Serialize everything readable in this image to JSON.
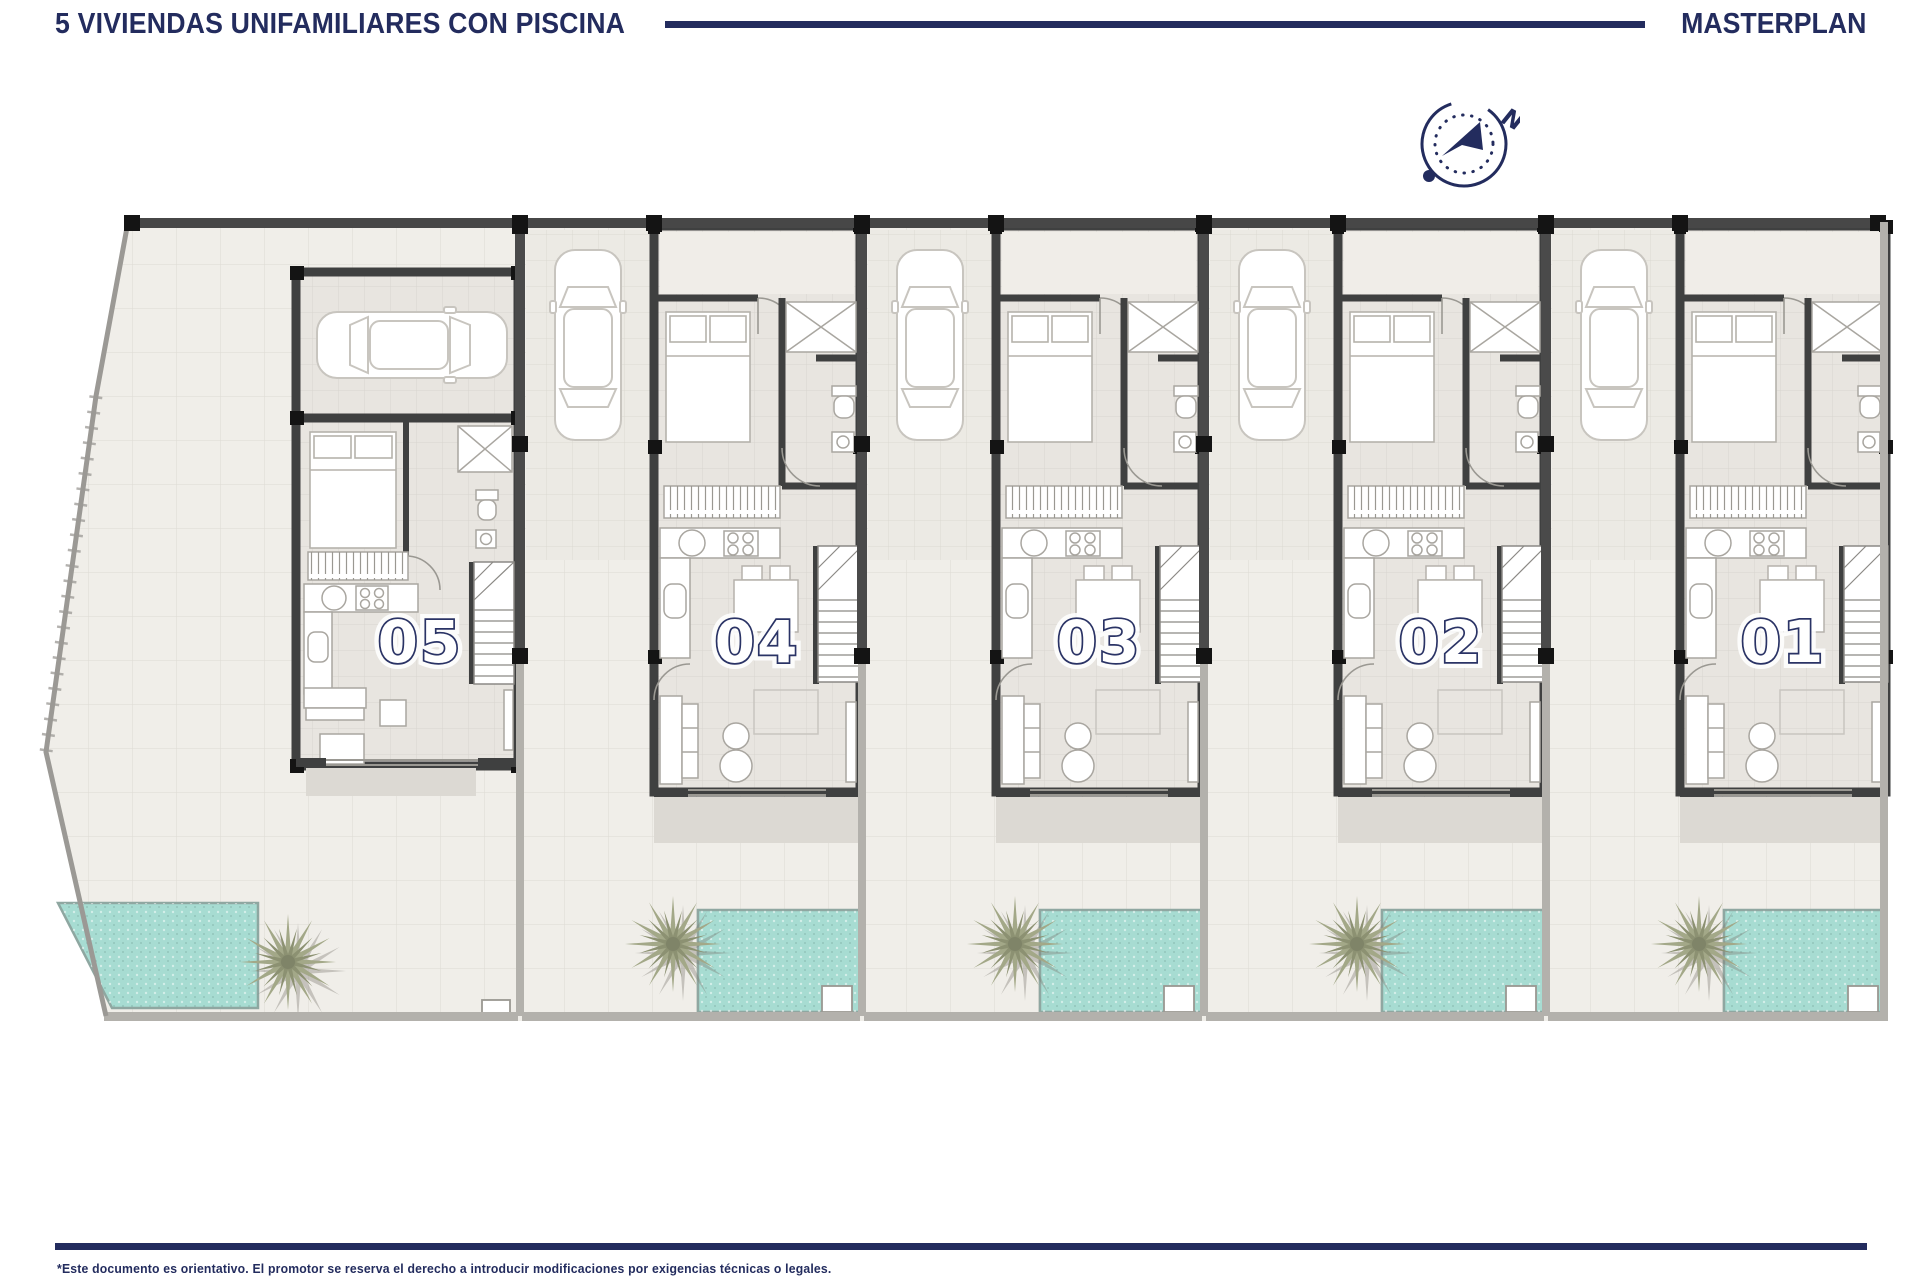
{
  "header": {
    "title": "5 VIVIENDAS UNIFAMILIARES CON PISCINA",
    "right_label": "MASTERPLAN"
  },
  "compass": {
    "north_label": "N"
  },
  "units": [
    {
      "number": "05"
    },
    {
      "number": "04"
    },
    {
      "number": "03"
    },
    {
      "number": "02"
    },
    {
      "number": "01"
    }
  ],
  "footer": {
    "disclaimer": "*Este documento es orientativo. El promotor se reserva el derecho a introducir modificaciones por exigencias técnicas o legales."
  },
  "colors": {
    "navy": "#232c5e",
    "pool": "#a7dcd2",
    "wall": "#3f4040",
    "floor": "#e8e5e0",
    "garden": "#f0eee9",
    "palm": "#a3a888",
    "fence": "#b3b1ac"
  }
}
